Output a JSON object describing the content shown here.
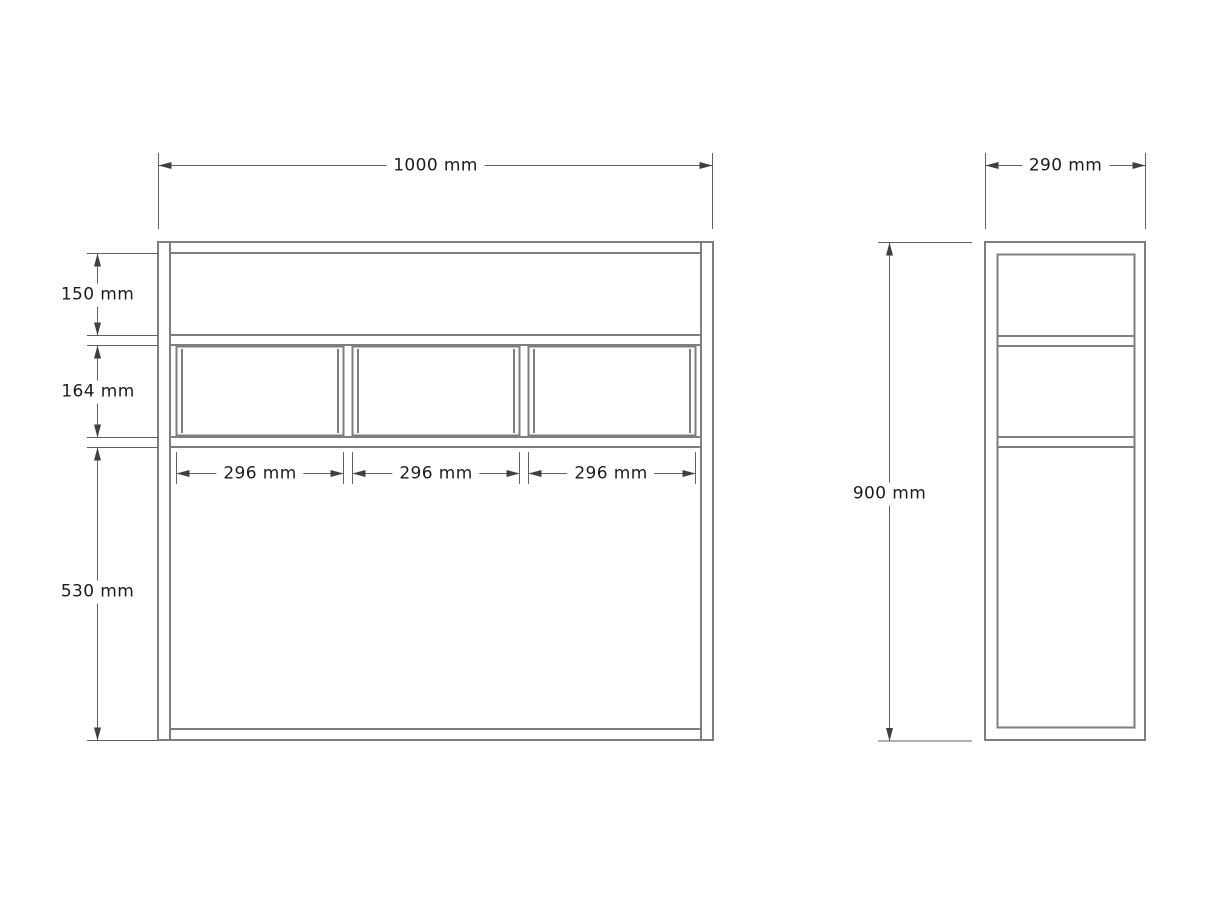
{
  "front_view": {
    "width_label": "1000 mm",
    "sections": [
      {
        "label": "150 mm"
      },
      {
        "label": "164 mm"
      },
      {
        "label": "530 mm"
      }
    ],
    "drawer_width_labels": [
      "296 mm",
      "296 mm",
      "296 mm"
    ]
  },
  "side_view": {
    "depth_label": "290 mm",
    "height_label": "900 mm"
  },
  "dimensions_mm": {
    "overall_width": 1000,
    "overall_height": 900,
    "overall_depth": 290,
    "top_section_height": 150,
    "drawer_section_height": 164,
    "bottom_section_height": 530,
    "drawer_width": 296
  },
  "colors": {
    "object_line": "#7e7e7e",
    "dimension_line": "#606060",
    "arrow": "#3f3f3f",
    "text": "#1c1c1c",
    "background": "#ffffff"
  }
}
